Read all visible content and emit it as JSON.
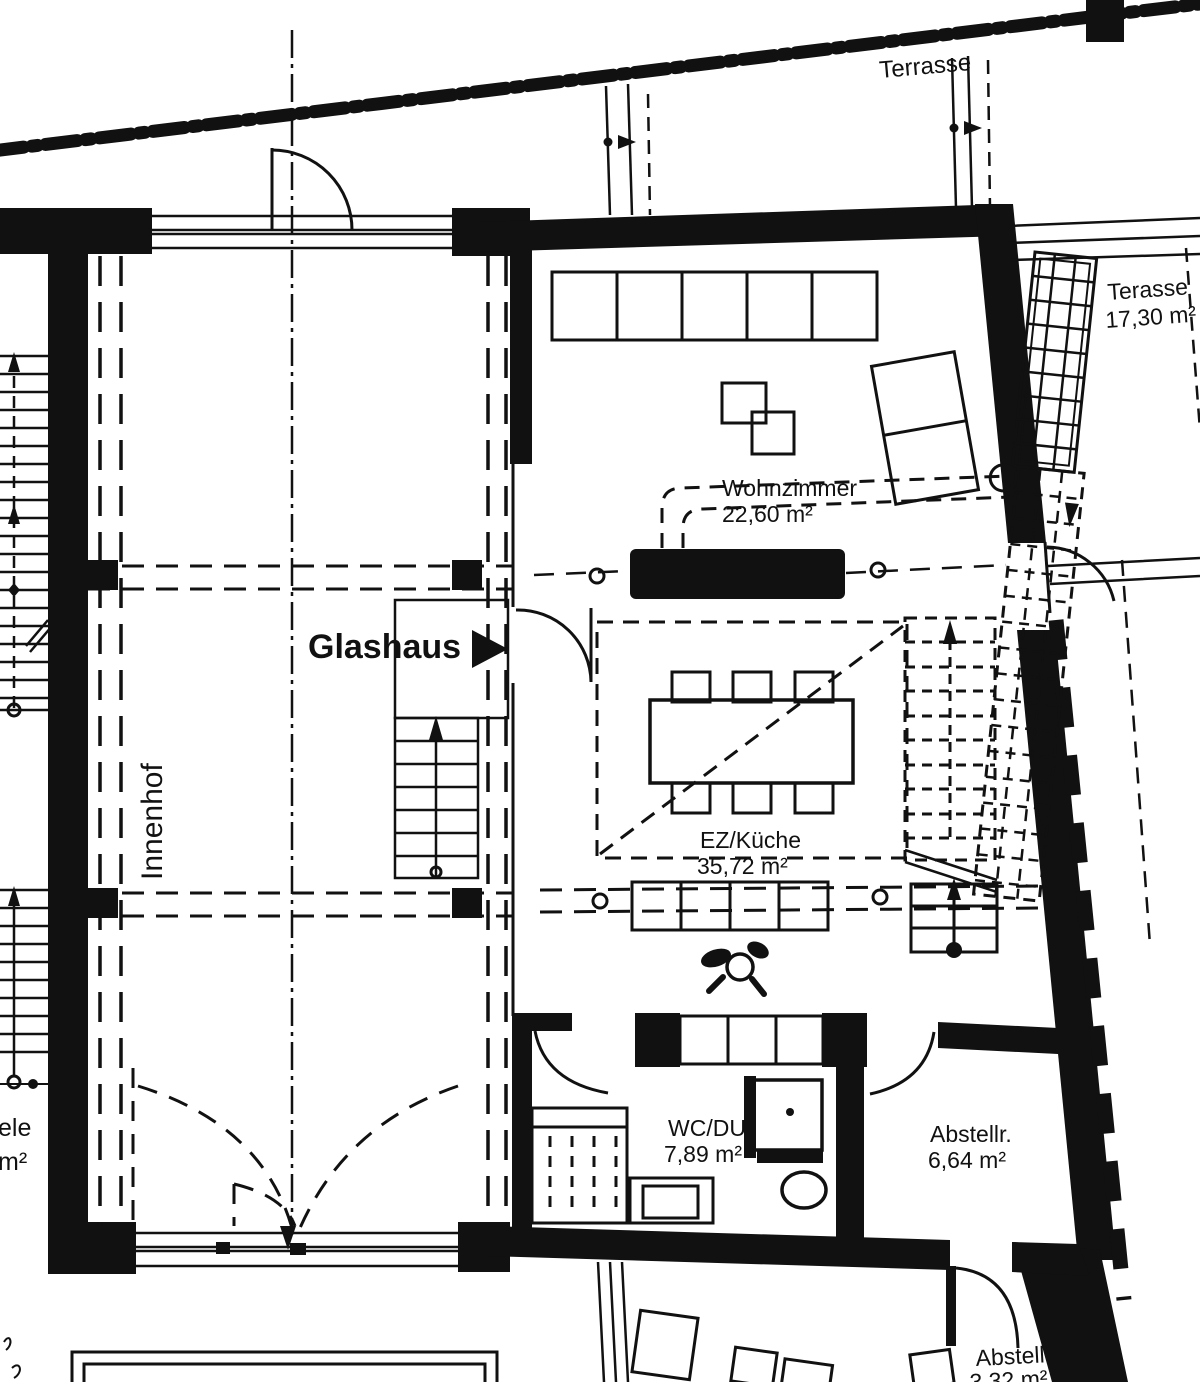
{
  "labels": {
    "terrasse_top": "Terrasse",
    "terrasse_right": {
      "name": "Terasse",
      "area": "17,30 m²"
    },
    "wohnzimmer": {
      "name": "Wohnzimmer",
      "area": "22,60 m²"
    },
    "glashaus": "Glashaus",
    "innenhof": "Innenhof",
    "ez_kueche": {
      "name": "EZ/Küche",
      "area": "35,72 m²"
    },
    "wc_du": {
      "name": "WC/DU",
      "area": "7,89 m²"
    },
    "abstellraum": {
      "name": "Abstellr.",
      "area": "6,64 m²"
    },
    "abstell_klein": {
      "name": "Abstell.",
      "area": "3,32 m²"
    },
    "diele_partial": {
      "name": "ele",
      "area": "m²"
    }
  },
  "colors": {
    "ink": "#111111",
    "paper": "#ffffff"
  }
}
